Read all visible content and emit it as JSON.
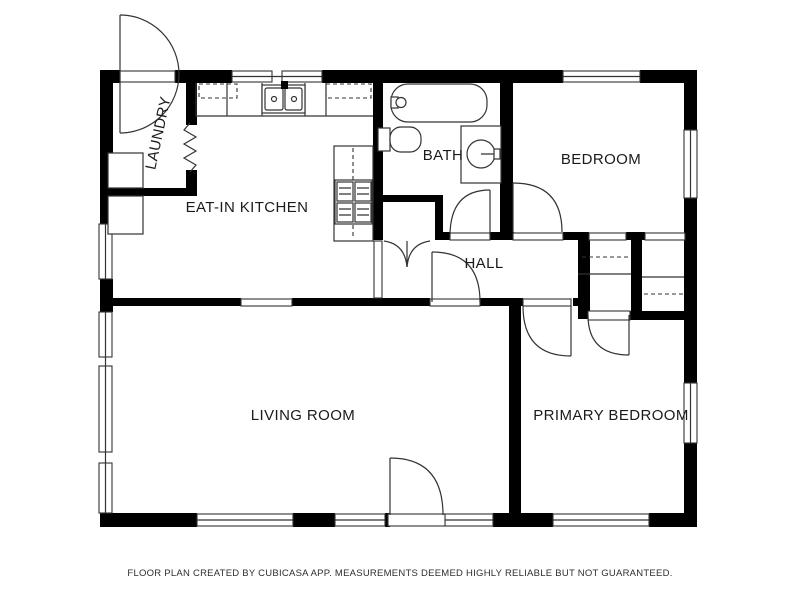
{
  "plan": {
    "background": "#ffffff",
    "wall_color": "#000000",
    "line_color": "#333333",
    "labels": {
      "laundry": "LAUNDRY",
      "eat_in_kitchen": "EAT-IN KITCHEN",
      "bath": "BATH",
      "bedroom": "BEDROOM",
      "hall": "HALL",
      "living_room": "LIVING ROOM",
      "primary_bedroom": "PRIMARY BEDROOM"
    },
    "fixtures": [
      "bathtub",
      "toilet",
      "vanity-sink",
      "double-kitchen-sink",
      "stove",
      "dishwasher-upper-cabinets",
      "refrigerator",
      "washer",
      "closet-shelves"
    ],
    "footer": "FLOOR PLAN CREATED BY CUBICASA APP. MEASUREMENTS DEEMED HIGHLY RELIABLE BUT NOT GUARANTEED."
  }
}
